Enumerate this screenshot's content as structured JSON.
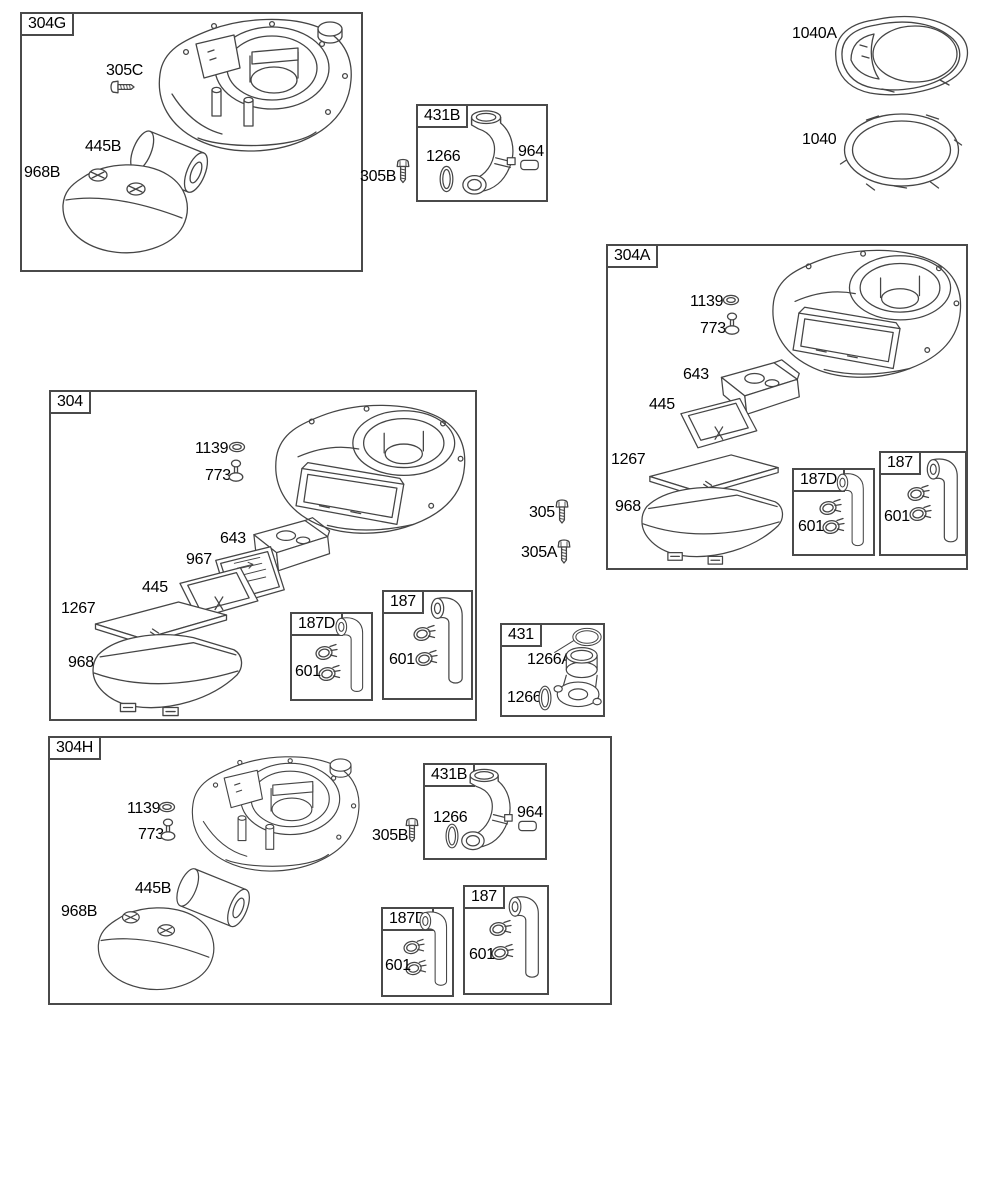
{
  "page": {
    "background_color": "#ffffff",
    "line_color": "#454545",
    "box_border_color": "#4a4a4a",
    "text_color": "#000000",
    "description": "Exploded parts diagram sheet: air cleaner and blower housing groups"
  },
  "part_labels": {
    "304G": "304G",
    "305C": "305C",
    "445B": "445B",
    "968B": "968B",
    "431B": "431B",
    "1266": "1266",
    "964": "964",
    "305B": "305B",
    "1040A": "1040A",
    "1040": "1040",
    "304A": "304A",
    "1139": "1139",
    "773": "773",
    "643": "643",
    "445": "445",
    "1267": "1267",
    "968": "968",
    "187D": "187D",
    "187": "187",
    "601": "601",
    "304": "304",
    "967": "967",
    "305": "305",
    "305A": "305A",
    "431": "431",
    "1266A": "1266A",
    "304H": "304H"
  },
  "groups": [
    {
      "id": "304G",
      "parts": [
        "305C",
        "445B",
        "968B"
      ]
    },
    {
      "id": "431B",
      "parts": [
        "1266",
        "964"
      ]
    },
    {
      "id": "304A",
      "parts": [
        "1139",
        "773",
        "643",
        "445",
        "1267",
        "968"
      ],
      "subgroups": [
        {
          "id": "187D",
          "parts": [
            "601"
          ]
        },
        {
          "id": "187",
          "parts": [
            "601"
          ]
        }
      ]
    },
    {
      "id": "304",
      "parts": [
        "1139",
        "773",
        "643",
        "967",
        "445",
        "1267",
        "968"
      ],
      "subgroups": [
        {
          "id": "187D",
          "parts": [
            "601"
          ]
        },
        {
          "id": "187",
          "parts": [
            "601"
          ]
        }
      ]
    },
    {
      "id": "431",
      "parts": [
        "1266A",
        "1266"
      ]
    },
    {
      "id": "304H",
      "parts": [
        "1139",
        "773",
        "445B",
        "968B",
        "305B"
      ],
      "subgroups": [
        {
          "id": "431B",
          "parts": [
            "1266",
            "964"
          ]
        },
        {
          "id": "187D",
          "parts": [
            "601"
          ]
        },
        {
          "id": "187",
          "parts": [
            "601"
          ]
        }
      ]
    }
  ],
  "loose_parts": [
    "1040A",
    "1040",
    "305B",
    "305",
    "305A"
  ]
}
